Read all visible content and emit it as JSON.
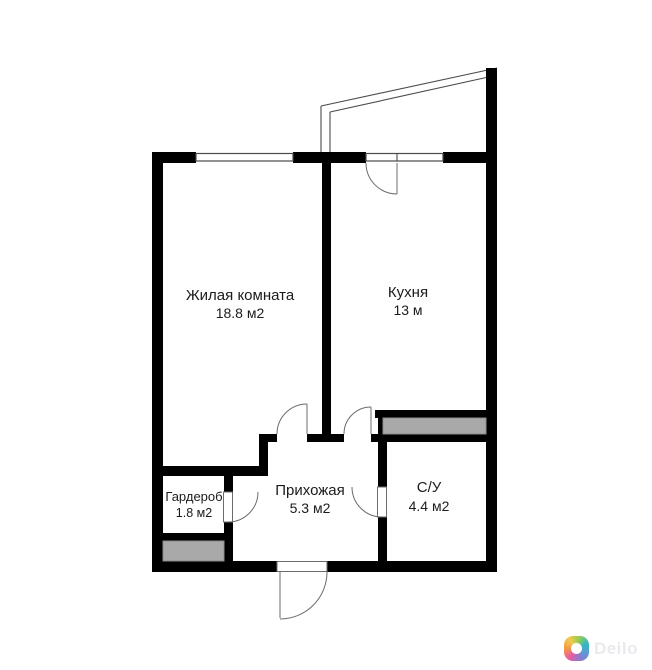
{
  "floor_plan": {
    "title": "apartment-floor-plan",
    "rooms": [
      {
        "id": "living-room",
        "name": "Жилая комната",
        "area": "18.8 м2"
      },
      {
        "id": "kitchen",
        "name": "Кухня",
        "area": "13 м"
      },
      {
        "id": "wardrobe",
        "name": "Гардероб",
        "area": "1.8 м2"
      },
      {
        "id": "hallway",
        "name": "Прихожая",
        "area": "5.3 м2"
      },
      {
        "id": "bathroom",
        "name": "С/У",
        "area": "4.4 м2"
      }
    ],
    "colors": {
      "wall": "#000000",
      "shaft_fill": "#a9a9a9",
      "line": "#4a4a4a",
      "label": "#1b1b1b",
      "background": "#ffffff"
    },
    "features": [
      "balcony-outline-top-right",
      "window-living-room-top",
      "balcony-door-and-window-kitchen-top",
      "entrance-door-bottom",
      "vent-shaft-near-bathroom",
      "duct-shaft-under-wardrobe"
    ]
  },
  "watermark": {
    "brand": "Deilo",
    "text_color": "#eaeaee",
    "logo_colors": [
      "#f2994a",
      "#f2c94c",
      "#9acd4f",
      "#35b8c0",
      "#5b9bd5",
      "#9575cd",
      "#e85d9e"
    ]
  }
}
